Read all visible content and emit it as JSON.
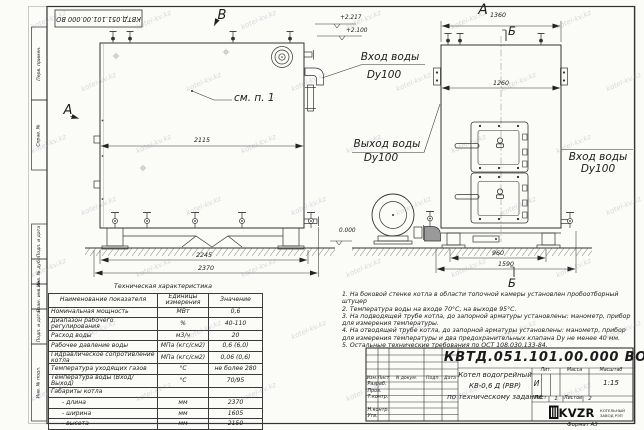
{
  "watermark": "kotel-kv.kz",
  "corner_stamp": "КВТД.051.101.00.000 ВО",
  "margin_labels": [
    "Перв. примен.",
    "Справ. №",
    "Подп. и дата",
    "Инв. № дубл.",
    "Взам. инв. №",
    "Подп. и дата",
    "Инв. № подл."
  ],
  "view_labels": {
    "side": "А",
    "top": "В",
    "section": "Б"
  },
  "callout": "см. п. 1",
  "elevations": {
    "top": "+2.217",
    "nozzle": "+2.100",
    "ground": "0.000"
  },
  "pipes": {
    "inlet_rear_1": "Вход воды",
    "inlet_rear_2": "Dy100",
    "outlet_1": "Выход воды",
    "outlet_2": "Dy100",
    "inlet_side_1": "Вход воды",
    "inlet_side_2": "Dy100"
  },
  "dims": {
    "side_top": "2115",
    "side_feet": "2245",
    "side_overall": "2370",
    "front_top": "1360",
    "front_inner": "1260",
    "front_base": "960",
    "front_overall": "1590"
  },
  "spec_table": {
    "title": "Техническая характеристика",
    "headers": [
      "Наименование показателя",
      "Единицы измерения",
      "Значение"
    ],
    "rows": [
      [
        "Номинальная мощность",
        "МВт",
        "0,6"
      ],
      [
        "Диапазон рабочего регулирования",
        "%",
        "40-110"
      ],
      [
        "Расход воды",
        "м3/ч",
        "20"
      ],
      [
        "Рабочее давление воды",
        "МПа (кгс/см2)",
        "0,6 (6,0)"
      ],
      [
        "Гидравлическое сопротивление котла",
        "МПа (кгс/см2)",
        "0,06 (0,6)"
      ],
      [
        "Температура уходящих газов",
        "°С",
        "не более 280"
      ],
      [
        "Температура воды (Вход/Выход)",
        "°С",
        "70/95"
      ],
      [
        "Габариты котла",
        "",
        ""
      ],
      [
        "- длина",
        "мм",
        "2370"
      ],
      [
        "- ширина",
        "мм",
        "1605"
      ],
      [
        "- высота",
        "мм",
        "2150"
      ]
    ]
  },
  "notes": [
    "1. На боковой стенке котла в области топочной камеры установлен пробоотборный штуцер",
    "2. Температура воды на входе 70°С, на выходе 95°С.",
    "3. На подводящей трубе котла, до запорной арматуры установлены: манометр, прибор для измерения температуры.",
    "4. На отводящей трубе котла, до запорной арматуры установлены: манометр, прибор для измерения температуры и два предохранительных клапана Dу не менее 40 мм.",
    "5. Остальные технические требования по ОСТ 108.030.133-84."
  ],
  "title_block": {
    "doc_number": "КВТД.051.101.00.000 ВО",
    "product_1": "Котел водогрейный",
    "product_2": "КВ-0,6 Д (РВР)",
    "product_3": "по техническому задание",
    "change_cols": [
      "Изм.",
      "Лист",
      "N докум.",
      "Подп.",
      "Дата"
    ],
    "sign_rows": [
      "Разраб.",
      "Пров.",
      "Т.контр.",
      "Н.контр.",
      "Утв."
    ],
    "lit_label": "Лит.",
    "lit_value": "И",
    "mass_label": "Масса",
    "scale_label": "Масштаб",
    "scale_value": "1:15",
    "sheet_label": "Лист",
    "sheet_value": "1",
    "sheets_label": "Листов",
    "sheets_value": "2",
    "logo_text": "KVZR",
    "logo_sub_1": "КОТЕЛЬНЫЙ",
    "logo_sub_2": "ЗАВОД РЭП",
    "format_label": "Формат А3"
  }
}
